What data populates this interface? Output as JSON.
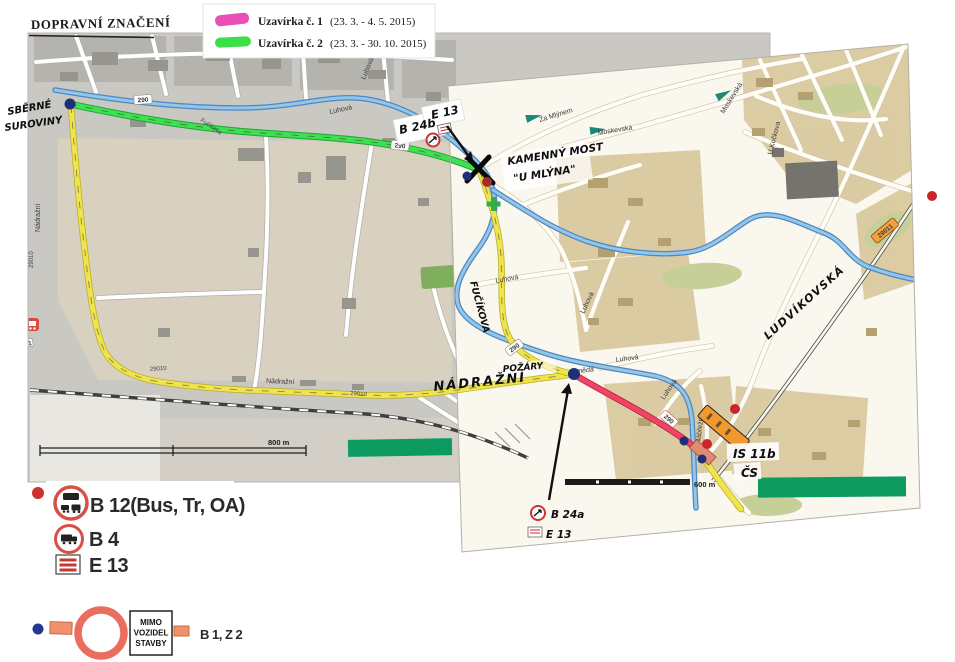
{
  "title": "DOPRAVNÍ ZNAČENÍ",
  "legend": {
    "item1": {
      "name": "Uzavírka č. 1",
      "dates": "(23. 3. - 4. 5. 2015)",
      "color": "#e94fb4"
    },
    "item2": {
      "name": "Uzavírka č. 2",
      "dates": "(23. 3. - 30. 10. 2015)",
      "color": "#3bdf47"
    }
  },
  "map": {
    "river": "Smědá",
    "streets": {
      "luhova": "Luhová",
      "fucikova": "Fučíkova",
      "nadrazni": "Nádražní",
      "za_mlynem": "Za Mlýnem",
      "moskevska": "Moskevská",
      "u_kockova": "U Kočkova",
      "nabrezni": "Nábřežní"
    },
    "roads": {
      "r290": "290",
      "r29010": "29010",
      "r29011": "29011",
      "r4201": "4201"
    },
    "scale1": "800 m",
    "scale2": "600 m",
    "notes": {
      "sberne1": "SBĚRNÉ",
      "sberne2": "SUROVINY",
      "most1": "KAMENNÝ MOST",
      "most2": "\"U MLÝNA\"",
      "fucikova": "FUČÍKOVA",
      "pozary": "POŽÁRY",
      "nadrazni": "NÁDRAŽNÍ",
      "ludvikovska": "LUDVÍKOVSKÁ",
      "cs": "ČS",
      "b24b": "B 24b",
      "e13_top": "E 13",
      "b24a": "B 24a",
      "e13_bottom": "E 13",
      "is11b": "IS 11b"
    }
  },
  "signs": {
    "b12": "B 12(Bus, Tr, OA)",
    "b4": "B 4",
    "e13": "E 13",
    "b1z2": "B 1, Z 2",
    "mimo": [
      "MIMO",
      "VOZIDEL",
      "STAVBY"
    ]
  }
}
